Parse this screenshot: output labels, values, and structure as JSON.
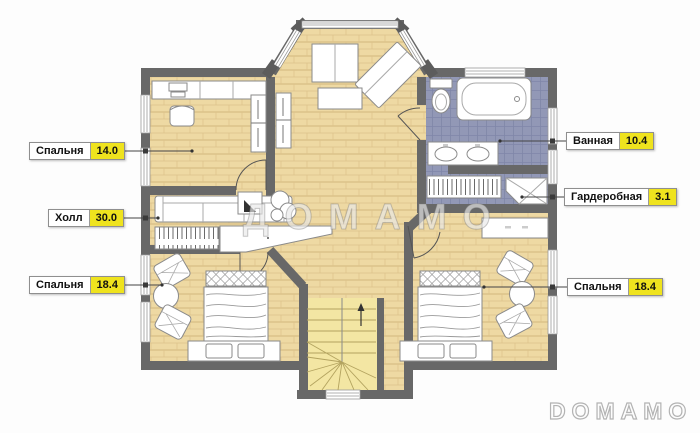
{
  "plan": {
    "labels": [
      {
        "name": "Спальня",
        "area": "14.0"
      },
      {
        "name": "Холл",
        "area": "30.0"
      },
      {
        "name": "Спальня",
        "area": "18.4"
      },
      {
        "name": "Ванная",
        "area": "10.4"
      },
      {
        "name": "Гардеробная",
        "area": "3.1"
      },
      {
        "name": "Спальня",
        "area": "18.4"
      }
    ],
    "watermark_center": "ДОМАМО",
    "watermark_corner": "DOMAMO",
    "colors": {
      "wall": "#686868",
      "wood_floor": "#eed9a3",
      "tile_floor": "#9298b6",
      "stair_floor": "#f3e6a3",
      "label_value_bg": "#efe31e"
    }
  }
}
